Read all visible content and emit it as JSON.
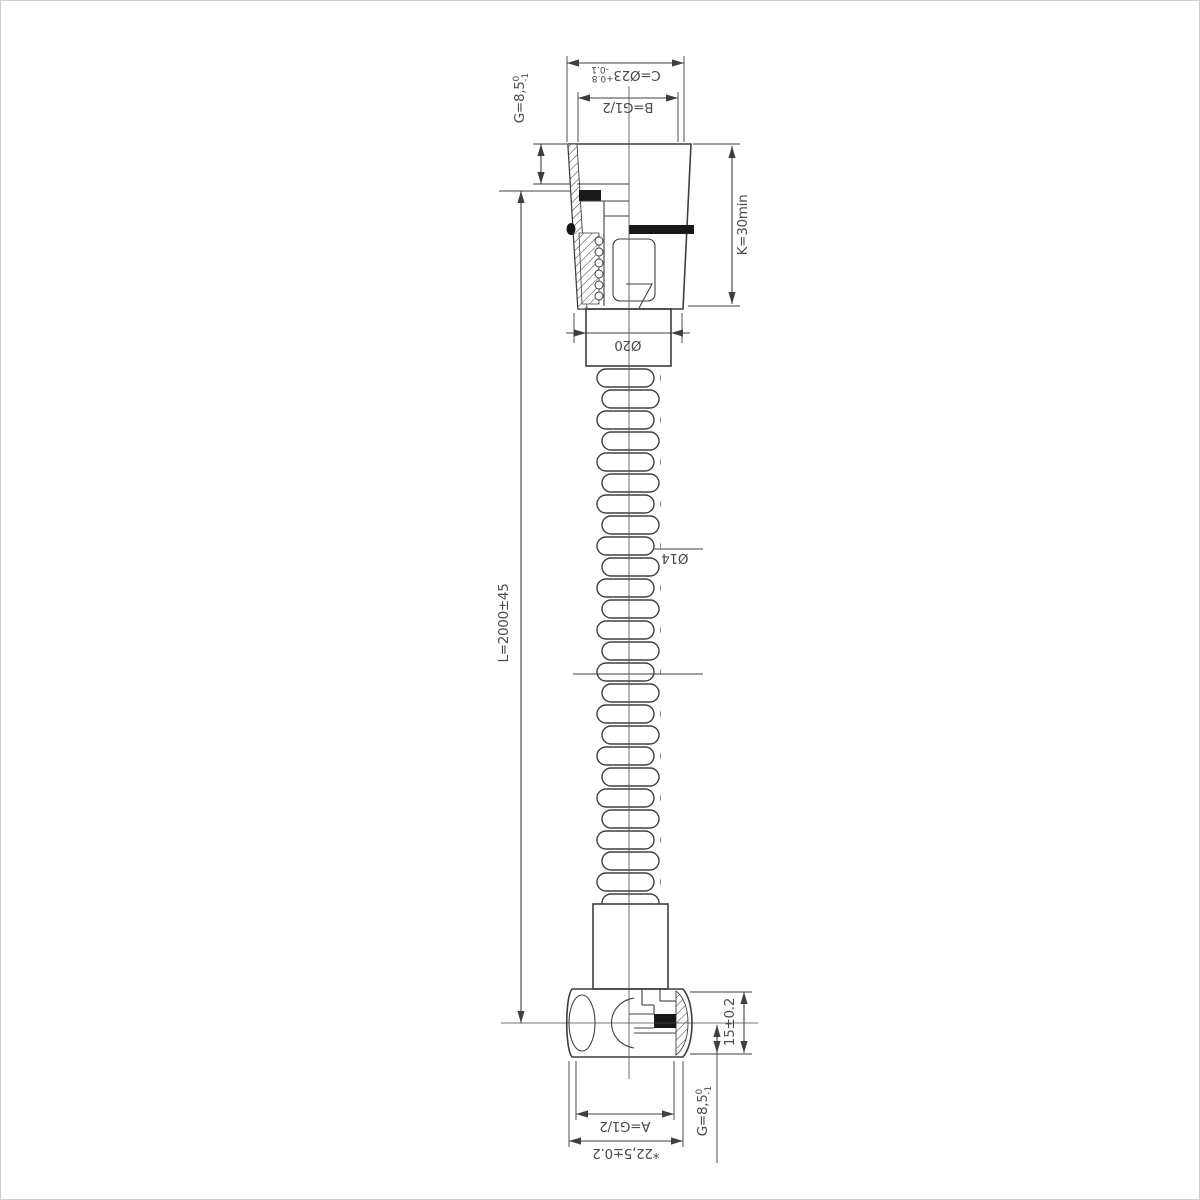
{
  "meta": {
    "type": "technical-drawing",
    "subject": "flexible shower hose with conical nuts, half-section views",
    "background": "#ffffff",
    "line_color": "#3f3f3f"
  },
  "dims": {
    "c": {
      "label": "C=Ø23",
      "tol_upper": "+0.8",
      "tol_lower": "-0.1"
    },
    "b": {
      "label": "B=G1/2"
    },
    "g_top": {
      "label": "G=8,5",
      "tol_upper": "0",
      "tol_lower": "-1"
    },
    "k": {
      "label": "K=30min"
    },
    "l": {
      "label": "L=2000±45"
    },
    "d20": {
      "label": "Ø20"
    },
    "d14": {
      "label": "Ø14"
    },
    "h15": {
      "label": "15±0.2"
    },
    "g_bottom": {
      "label": "G=8,5",
      "tol_upper": "0",
      "tol_lower": "-1"
    },
    "a": {
      "label": "A=G1/2"
    },
    "w": {
      "label": "*22,5±0.2"
    }
  }
}
